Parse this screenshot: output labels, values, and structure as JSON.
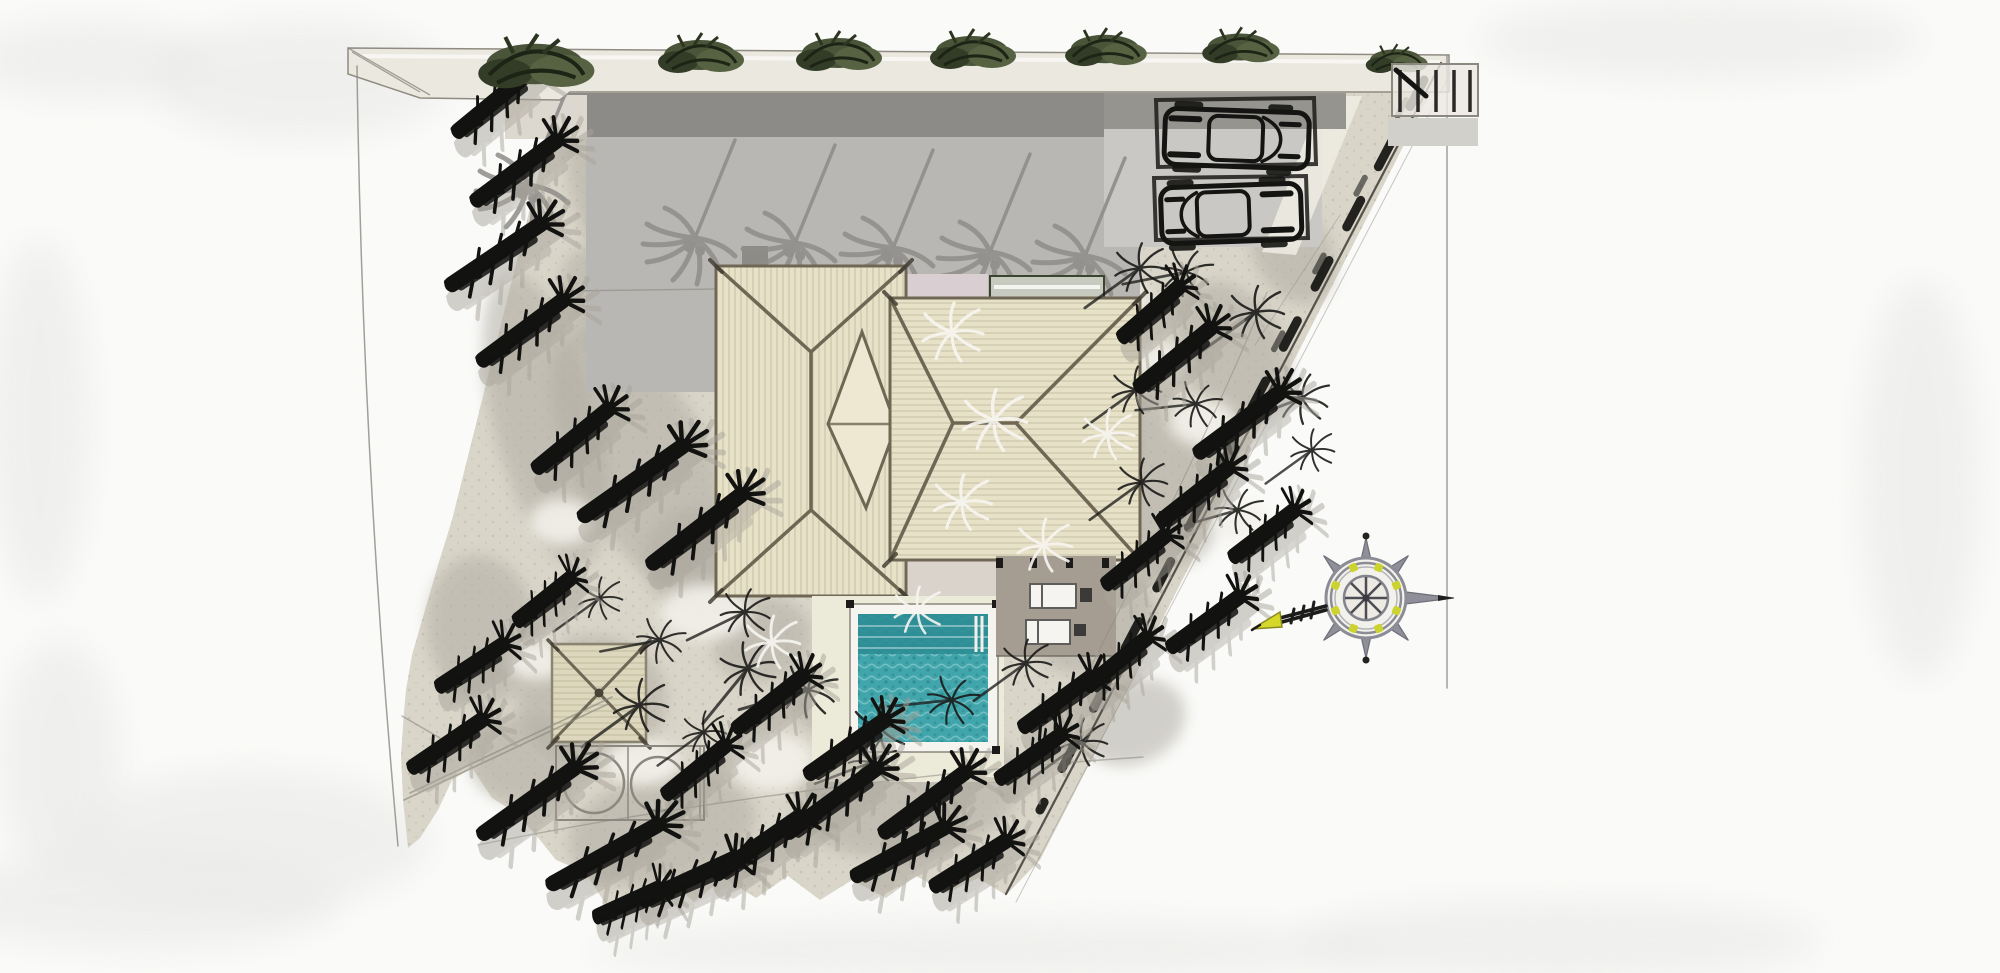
{
  "colors": {
    "paper": "#fafaf8",
    "wash": "#e9e9e7",
    "ground": "#d9d5c9",
    "ground_shadow": "#b1ada3",
    "ground_highlight": "#f3f1ea",
    "wall_band": "#ebe8e0",
    "driveway": "#b9b7b3",
    "driveway_dark": "#8c8b88",
    "driveway_dark2": "#96948f",
    "parking_pad": "#cac8c4",
    "driveway_palm": "#8f8d89",
    "roof": "#e7e1c8",
    "roof_line": "#6f6754",
    "roof_diamond": "#eee8d2",
    "pink_walk": "#d9ced2",
    "pergola_strip": "#c7cbbf",
    "pergola_edge": "#3c4430",
    "porch": "#d9d3cc",
    "terrace": "#a59d92",
    "lounger": "#f5f4f0",
    "lounger_frame": "#5f5e5a",
    "pool_water": "#41a6ac",
    "pool_water_dark": "#2e8d95",
    "pool_deck": "#ecead9",
    "pool_coping": "#f6f4ee",
    "pavilion_roof": "#ddd7bd",
    "foliage": "#4a5439",
    "palm_black": "#121210",
    "palm_gray": "#a9a59b",
    "pencil": "#8b8880",
    "boundary": "#55524c",
    "compass_ring": "#8c8c96",
    "compass_accent": "#ccd32e",
    "compass_arrow": "#d6d829"
  },
  "scene": {
    "black_palms": [
      [
        498,
        100,
        -30,
        115
      ],
      [
        522,
        168,
        -28,
        125
      ],
      [
        502,
        252,
        -26,
        135
      ],
      [
        528,
        328,
        -28,
        125
      ],
      [
        578,
        436,
        -30,
        115
      ],
      [
        640,
        478,
        -28,
        150
      ],
      [
        703,
        526,
        -30,
        140
      ],
      [
        548,
        598,
        -26,
        85
      ],
      [
        476,
        664,
        -22,
        95
      ],
      [
        452,
        742,
        -24,
        105
      ],
      [
        535,
        798,
        -28,
        140
      ],
      [
        612,
        852,
        -22,
        150
      ],
      [
        695,
        878,
        -16,
        125
      ],
      [
        764,
        843,
        -26,
        125
      ],
      [
        838,
        798,
        -28,
        135
      ],
      [
        906,
        850,
        -20,
        125
      ],
      [
        975,
        862,
        -22,
        105
      ],
      [
        700,
        768,
        -28,
        95
      ],
      [
        632,
        902,
        -12,
        85
      ],
      [
        775,
        700,
        -28,
        105
      ],
      [
        852,
        745,
        -26,
        115
      ],
      [
        930,
        800,
        -28,
        125
      ],
      [
        1180,
        355,
        -30,
        115
      ],
      [
        1245,
        420,
        -28,
        125
      ],
      [
        1200,
        492,
        -28,
        105
      ],
      [
        1268,
        532,
        -26,
        95
      ],
      [
        1140,
        558,
        -28,
        95
      ],
      [
        1210,
        620,
        -26,
        105
      ],
      [
        1062,
        700,
        -26,
        105
      ],
      [
        1122,
        660,
        -28,
        95
      ],
      [
        1155,
        310,
        -30,
        95
      ],
      [
        1035,
        755,
        -24,
        95
      ]
    ],
    "driveway_palm_shadows": [
      [
        695,
        238
      ],
      [
        795,
        243
      ],
      [
        893,
        248
      ],
      [
        990,
        252
      ],
      [
        1085,
        256
      ],
      [
        528,
        185
      ]
    ],
    "star_palms": [
      [
        640,
        705,
        1,
        0
      ],
      [
        745,
        612,
        0.9,
        10
      ],
      [
        748,
        668,
        1,
        -15
      ],
      [
        808,
        690,
        1,
        20
      ],
      [
        880,
        728,
        1,
        0
      ],
      [
        952,
        700,
        0.9,
        30
      ],
      [
        1026,
        663,
        0.9,
        0
      ],
      [
        1140,
        268,
        0.95,
        0
      ],
      [
        1186,
        272,
        0.9,
        25
      ],
      [
        1256,
        312,
        1,
        0
      ],
      [
        1302,
        398,
        0.95,
        15
      ],
      [
        1136,
        390,
        0.9,
        0
      ],
      [
        1196,
        404,
        0.85,
        30
      ],
      [
        1142,
        482,
        0.9,
        0
      ],
      [
        1238,
        510,
        0.85,
        20
      ],
      [
        1082,
        742,
        0.9,
        0
      ],
      [
        872,
        762,
        0.85,
        15
      ],
      [
        704,
        732,
        0.8,
        0
      ],
      [
        600,
        598,
        0.8,
        0
      ],
      [
        1312,
        450,
        0.8,
        0
      ],
      [
        660,
        640,
        0.85,
        25
      ]
    ],
    "white_palms": [
      [
        952,
        332,
        1
      ],
      [
        994,
        420,
        1.05
      ],
      [
        962,
        502,
        0.95
      ],
      [
        1044,
        545,
        0.9
      ],
      [
        772,
        642,
        0.9
      ],
      [
        1108,
        434,
        0.85
      ],
      [
        918,
        610,
        0.8
      ]
    ],
    "foliage_clumps": [
      [
        535,
        64,
        1.35
      ],
      [
        700,
        55,
        1
      ],
      [
        838,
        53,
        1
      ],
      [
        972,
        51,
        1
      ],
      [
        1105,
        49,
        0.95
      ],
      [
        1240,
        47,
        0.9
      ],
      [
        1396,
        60,
        0.72
      ]
    ],
    "gray_blobs": [
      [
        612,
        200,
        38,
        85,
        -18
      ],
      [
        545,
        420,
        52,
        150,
        -14
      ],
      [
        642,
        462,
        68,
        145,
        -28
      ],
      [
        482,
        630,
        55,
        75,
        -8
      ],
      [
        592,
        700,
        75,
        65,
        0
      ],
      [
        762,
        640,
        50,
        42,
        -18
      ],
      [
        700,
        562,
        55,
        55,
        0
      ],
      [
        908,
        792,
        115,
        65,
        -8
      ],
      [
        662,
        830,
        95,
        55,
        -12
      ],
      [
        1048,
        428,
        90,
        135,
        -12
      ],
      [
        1152,
        482,
        60,
        90,
        -28
      ],
      [
        1232,
        352,
        52,
        75,
        -28
      ],
      [
        1092,
        622,
        65,
        50,
        -18
      ],
      [
        1292,
        252,
        38,
        55,
        -28
      ],
      [
        1132,
        722,
        55,
        42,
        -22
      ],
      [
        524,
        760,
        55,
        45,
        0
      ],
      [
        836,
        700,
        45,
        35,
        -15
      ],
      [
        602,
        305,
        40,
        60,
        -20
      ]
    ],
    "white_patches": [
      [
        705,
        612,
        45,
        28
      ],
      [
        862,
        692,
        38,
        26
      ],
      [
        982,
        572,
        33,
        20
      ],
      [
        562,
        522,
        33,
        23
      ],
      [
        772,
        762,
        42,
        28
      ],
      [
        1202,
        422,
        33,
        23
      ],
      [
        1242,
        522,
        28,
        20
      ],
      [
        642,
        762,
        38,
        23
      ],
      [
        1092,
        562,
        30,
        20
      ],
      [
        902,
        642,
        33,
        20
      ],
      [
        1162,
        362,
        28,
        18
      ],
      [
        536,
        660,
        30,
        20
      ],
      [
        1120,
        300,
        30,
        20
      ]
    ],
    "paper_washes": [
      [
        90,
        60,
        120,
        40
      ],
      [
        40,
        420,
        50,
        180
      ],
      [
        140,
        900,
        200,
        50
      ],
      [
        300,
        80,
        150,
        60
      ],
      [
        1700,
        40,
        220,
        40
      ],
      [
        1920,
        480,
        60,
        200
      ],
      [
        1560,
        940,
        260,
        40
      ],
      [
        990,
        950,
        400,
        30
      ],
      [
        60,
        760,
        60,
        120
      ],
      [
        250,
        840,
        180,
        70
      ]
    ]
  }
}
